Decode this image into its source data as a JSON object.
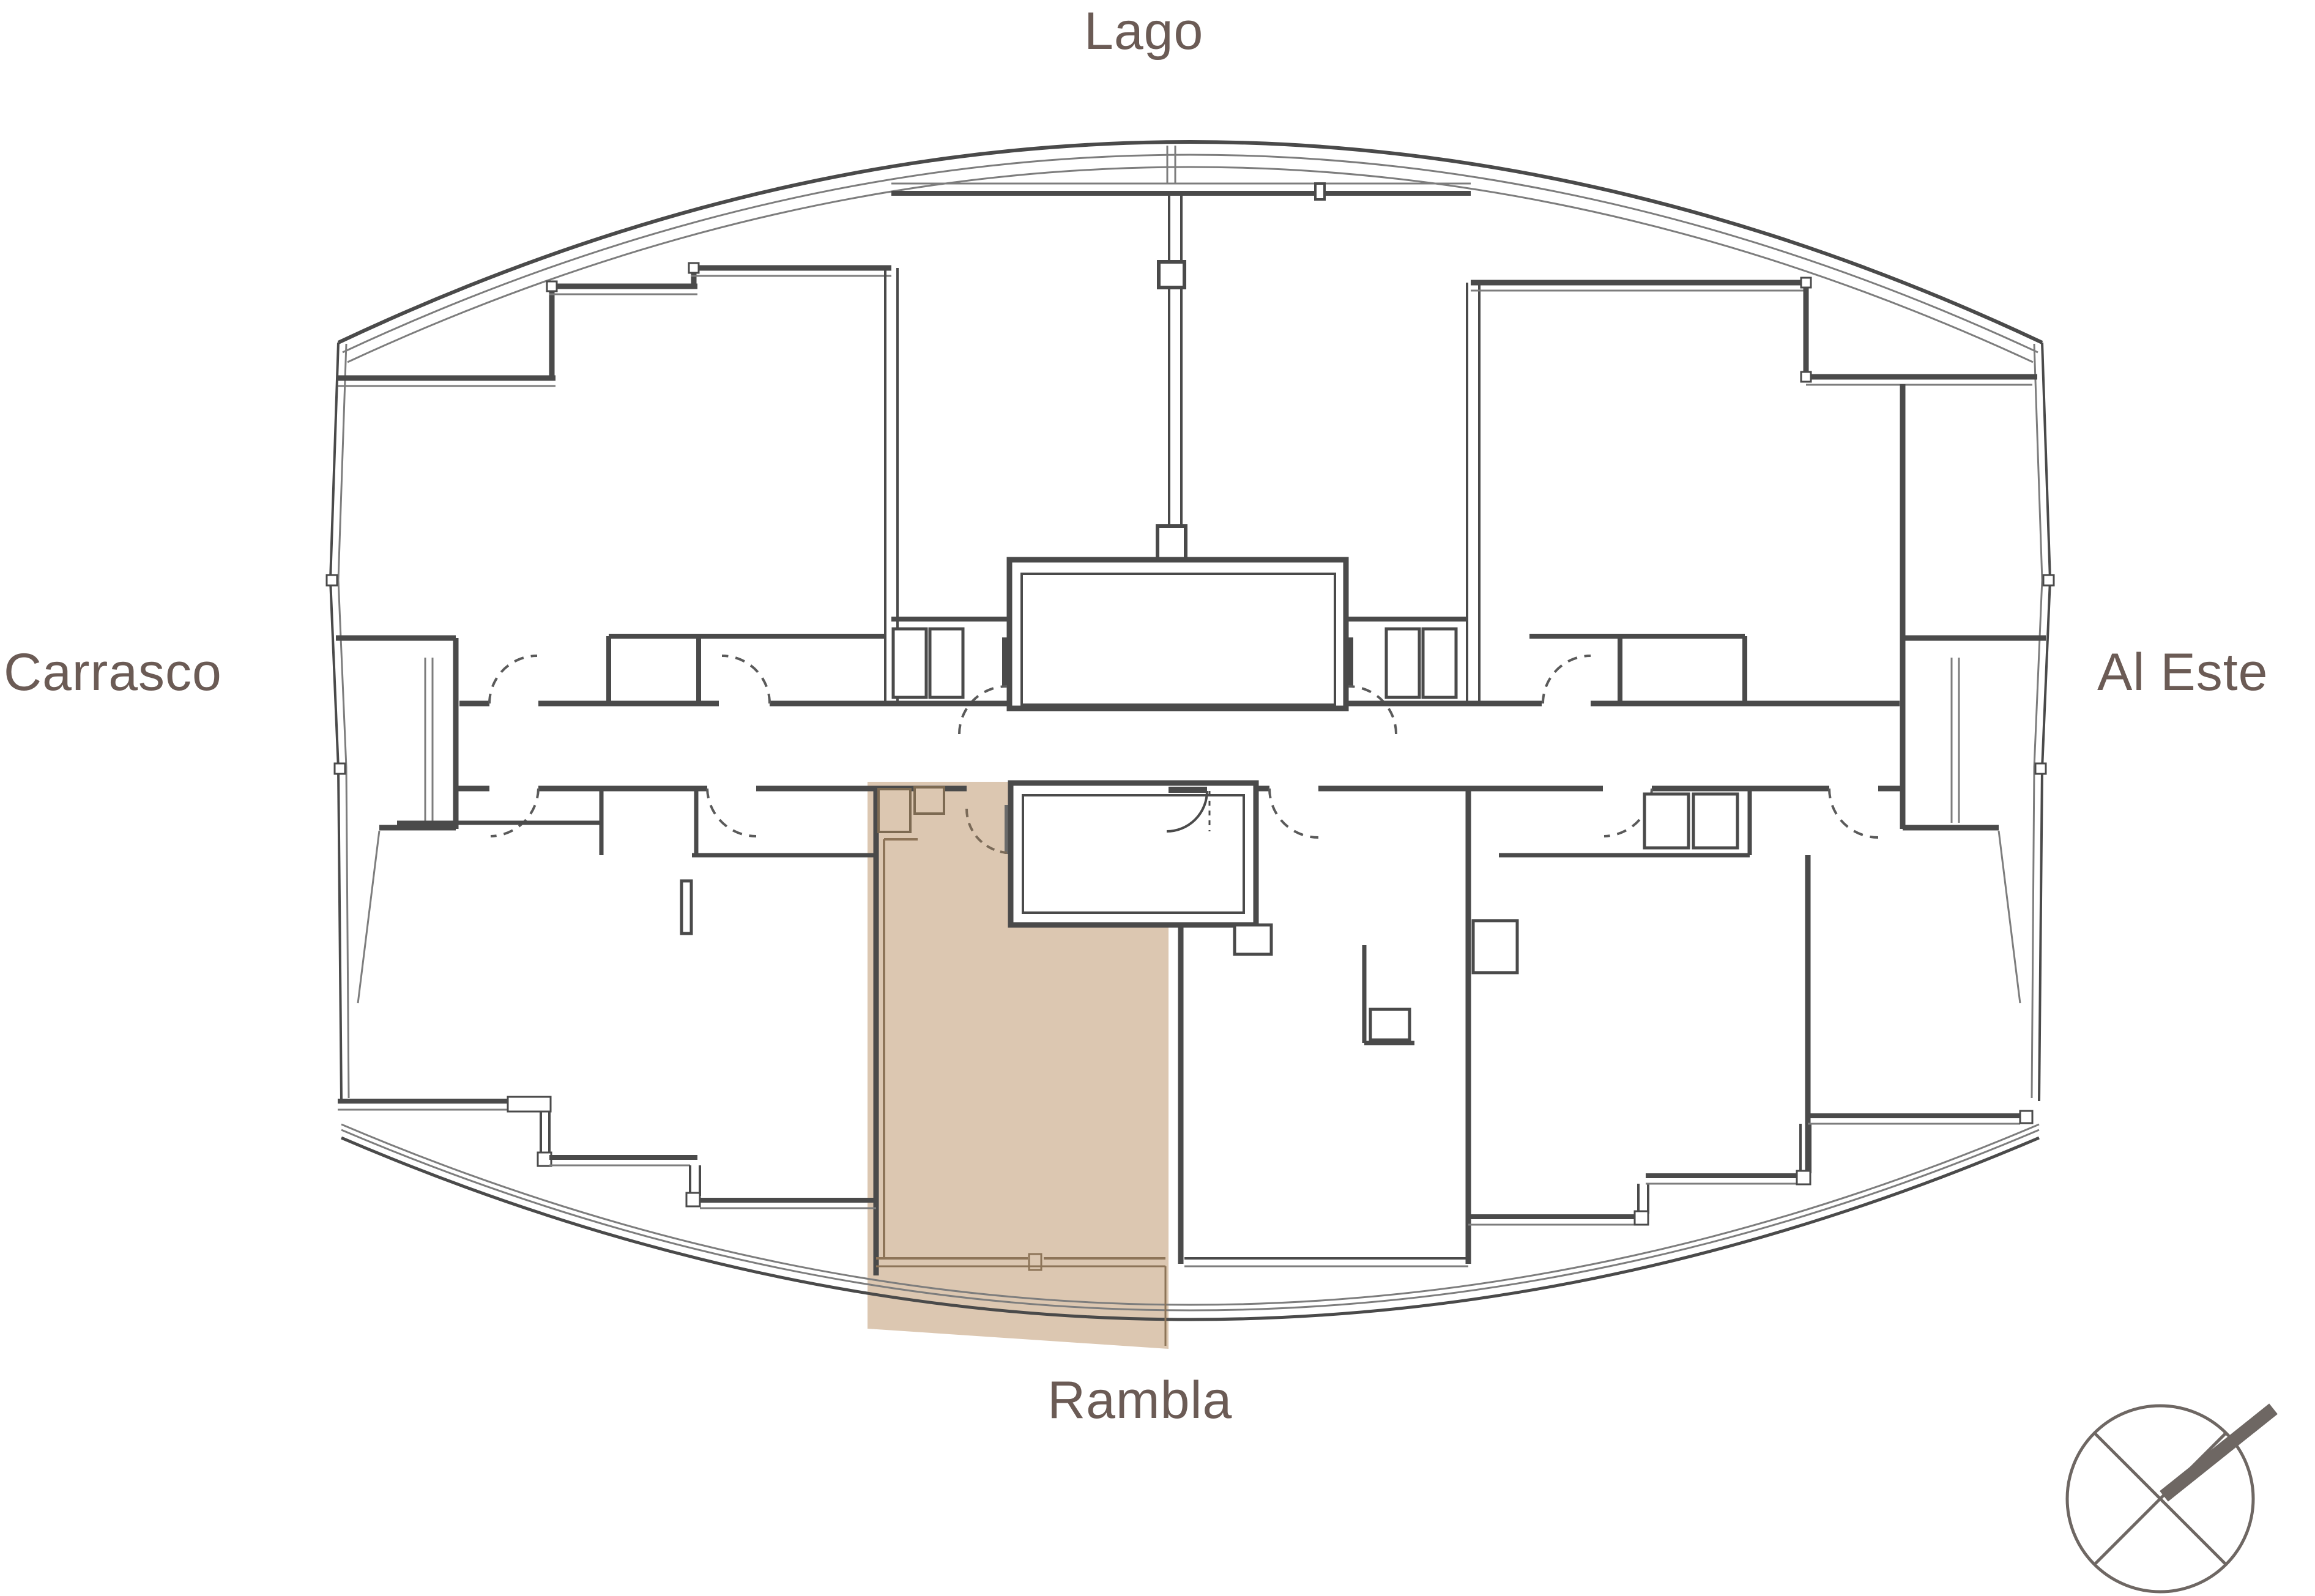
{
  "plan": {
    "labels": {
      "top": "Lago",
      "left": "Carrasco",
      "right": "Al Este",
      "bottom": "Rambla"
    },
    "colors": {
      "background": "#ffffff",
      "label": "#6b5b55",
      "wall": "#4a4a4a",
      "thin_line": "#7d7d7d",
      "highlight_fill": "#dcc7b1",
      "highlight_line": "#8d7458",
      "compass": "#6e6763"
    },
    "highlighted_unit": {
      "position": "lower-center",
      "faces_label": "Rambla"
    },
    "compass": {
      "arrow_direction": "northeast"
    }
  }
}
